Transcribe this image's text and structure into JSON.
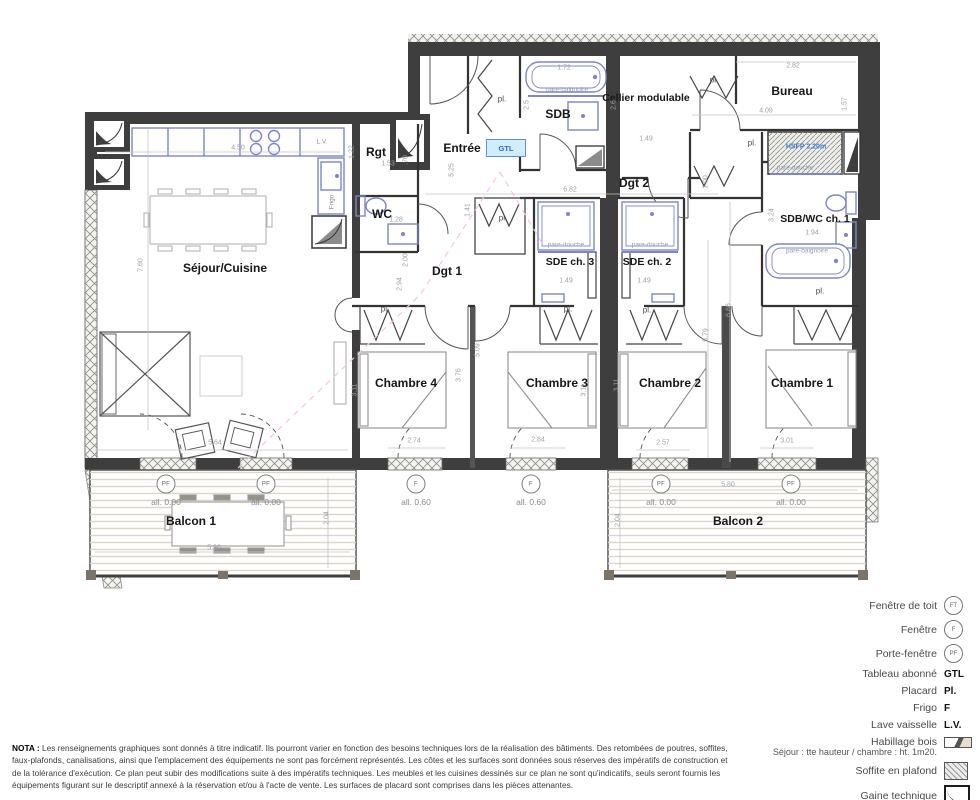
{
  "colors": {
    "wall": "#3e3e3e",
    "fixture_blue": "#7e85c8",
    "gtl_fill": "#cdeefa",
    "blue_text": "#3a78d0",
    "dim_text": "#9aa0a6",
    "pink_dash": "#f2c4ec"
  },
  "rooms": {
    "sejour": "Séjour/Cuisine",
    "rgt": "Rgt",
    "wc": "WC",
    "entree": "Entrée",
    "sdb": "SDB",
    "cellier": "Cellier modulable",
    "bureau": "Bureau",
    "dgt1": "Dgt 1",
    "dgt2": "Dgt 2",
    "sde3": "SDE ch. 3",
    "sde2": "SDE ch. 2",
    "sdbwc1": "SDB/WC ch. 1",
    "ch4": "Chambre 4",
    "ch3": "Chambre 3",
    "ch2": "Chambre 2",
    "ch1": "Chambre 1",
    "balcon1": "Balcon 1",
    "balcon2": "Balcon 2"
  },
  "annotations": {
    "pl": "pl.",
    "gtl": "GTL",
    "hsfp": "HSFP 2.20m",
    "pare_baignoire": "pare-baignoire",
    "pare_douche": "pare-douche",
    "frigo": "Frigo",
    "lv": "L.V.",
    "all000": "all. 0.00",
    "all060": "all. 0.60",
    "pf": "PF",
    "f": "F",
    "ft": "FT"
  },
  "dims": {
    "kitchen_w": "4.50",
    "sejour_h": "7.60",
    "sejour_w": "5.64",
    "rgt_h": "1.22",
    "rgt_w": "1.53",
    "rgt_gap": ".70",
    "entree_h": "5.25",
    "wc_h": "1.41",
    "wc_w": "1.28",
    "sdb_tub_w": "1.72",
    "sdb_h": "2.5",
    "cellier_h": "2.6",
    "cellier_w": "1.49",
    "dgt2_w": "6.82",
    "bureau_w_top": "2.82",
    "bureau_h": "1.57",
    "bureau_w_bot": "4.09",
    "dgt2_e": "1.00",
    "sdbwc_h": "3.24",
    "sdbwc_w": "1.94",
    "dgt1_h1": "2.00",
    "dgt1_h2": "2.94",
    "corridor_h": "5.09",
    "ch4_h": "3.76",
    "ch4_side": "3.11",
    "ch3_side": "3.11",
    "ch2_side": "3.11",
    "ch12_h1": "5.79",
    "ch12_h2": "6.86",
    "ch4_w": "2.74",
    "ch3_w": "2.84",
    "ch2_w": "2.57",
    "ch1_w": "3.01",
    "sde3_w": "1.49",
    "sde2_w": "1.49",
    "balcon1_w": "5.90",
    "balcon1_h": "2.04",
    "balcon2_w": "5.80",
    "balcon2_h": "2.04"
  },
  "legend": {
    "items": [
      {
        "label": "Fenêtre de toit",
        "symbol": "FT"
      },
      {
        "label": "Fenêtre",
        "symbol": "F"
      },
      {
        "label": "Porte-fenêtre",
        "symbol": "PF"
      },
      {
        "label": "Tableau abonné",
        "symbol": "GTL"
      },
      {
        "label": "Placard",
        "symbol": "Pl."
      },
      {
        "label": "Frigo",
        "symbol": "F"
      },
      {
        "label": "Lave vaisselle",
        "symbol": "L.V."
      },
      {
        "label": "Habillage bois",
        "symbol": ""
      },
      {
        "label": "Soffite en plafond",
        "symbol": ""
      },
      {
        "label": "Gaine technique",
        "symbol": ""
      }
    ],
    "note": "Séjour : tte hauteur / chambre : ht. 1m20."
  },
  "nota": {
    "title": "NOTA :",
    "text": " Les renseignements graphiques sont donnés à titre indicatif. Ils pourront varier en fonction des besoins techniques lors de la réalisation des bâtiments. Des retombées de poutres, soffites, faux-plafonds, canalisations, ainsi que l'emplacement des équipements ne sont pas forcément représentés. Les côtes et les surfaces sont données sous réserves des impératifs de construction et de la tolérance d'exécution. Ce plan peut subir des modifications suite à des impératifs techniques. Les meubles et les cuisines dessinés sur ce plan ne sont qu'indicatifs, seuls seront fournis les équipements figurant sur le descriptif annexé à la réservation et/ou à l'acte de vente. Les surfaces de placard sont comprises dans les pièces attenantes."
  }
}
